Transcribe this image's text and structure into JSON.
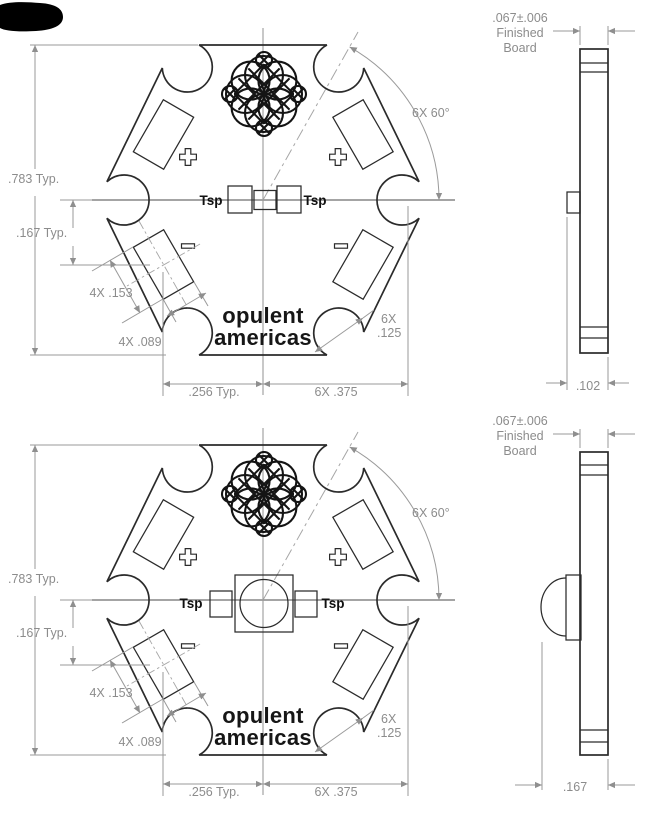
{
  "top_view": {
    "dims": {
      "height": ".783 Typ.",
      "pad_offset": ".167 Typ.",
      "pad_length": "4X .153",
      "pad_width": "4X .089",
      "center_offset": ".256 Typ.",
      "point_distance": "6X .375",
      "angle": "6X 60°",
      "notch_qty": "6X",
      "notch_size": ".125"
    },
    "board": {
      "tsp_left": "Tsp",
      "tsp_right": "Tsp",
      "plus_symbol": "+",
      "minus_symbol": "−",
      "logo_line1": "opulent",
      "logo_line2": "americas"
    },
    "side_view": {
      "thickness_line1": ".067±.006",
      "thickness_line2": "Finished",
      "thickness_line3": "Board",
      "overall_height": ".102"
    }
  },
  "bottom_view": {
    "dims": {
      "height": ".783 Typ.",
      "pad_offset": ".167 Typ.",
      "pad_length": "4X .153",
      "pad_width": "4X .089",
      "center_offset": ".256 Typ.",
      "point_distance": "6X .375",
      "angle": "6X 60°",
      "notch_qty": "6X",
      "notch_size": ".125"
    },
    "board": {
      "tsp_left": "Tsp",
      "tsp_right": "Tsp",
      "plus_symbol": "+",
      "minus_symbol": "−",
      "logo_line1": "opulent",
      "logo_line2": "americas"
    },
    "side_view": {
      "thickness_line1": ".067±.006",
      "thickness_line2": "Finished",
      "thickness_line3": "Board",
      "overall_height": ".167"
    }
  }
}
